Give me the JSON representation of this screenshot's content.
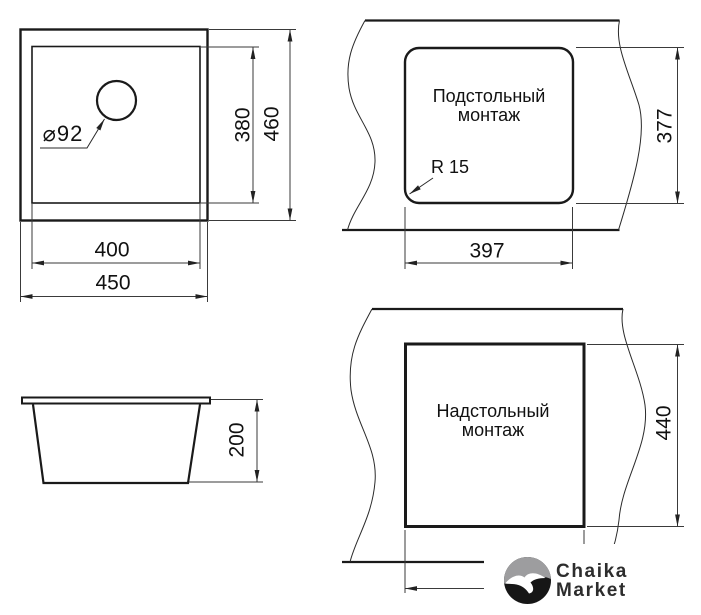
{
  "drawing": {
    "plan_view": {
      "drain_label": "⌀92",
      "dim_inner_height": "380",
      "dim_outer_height": "460",
      "dim_inner_width": "400",
      "dim_outer_width": "450"
    },
    "undermount_view": {
      "title_line1": "Подстольный",
      "title_line2": "монтаж",
      "radius_label": "R 15",
      "dim_width": "397",
      "dim_height": "377"
    },
    "side_view": {
      "dim_depth": "200"
    },
    "topmount_view": {
      "title_line1": "Надстольный",
      "title_line2": "монтаж",
      "dim_height": "440"
    },
    "logo": {
      "line1": "Chaika",
      "line2": "Market"
    },
    "colors": {
      "object_line": "#1a1a1a",
      "thin_line": "#3a3a3a",
      "background": "#ffffff",
      "logo_gray": "#9d9d9f",
      "logo_dark": "#161616",
      "logo_text": "#2d2d2d"
    }
  }
}
